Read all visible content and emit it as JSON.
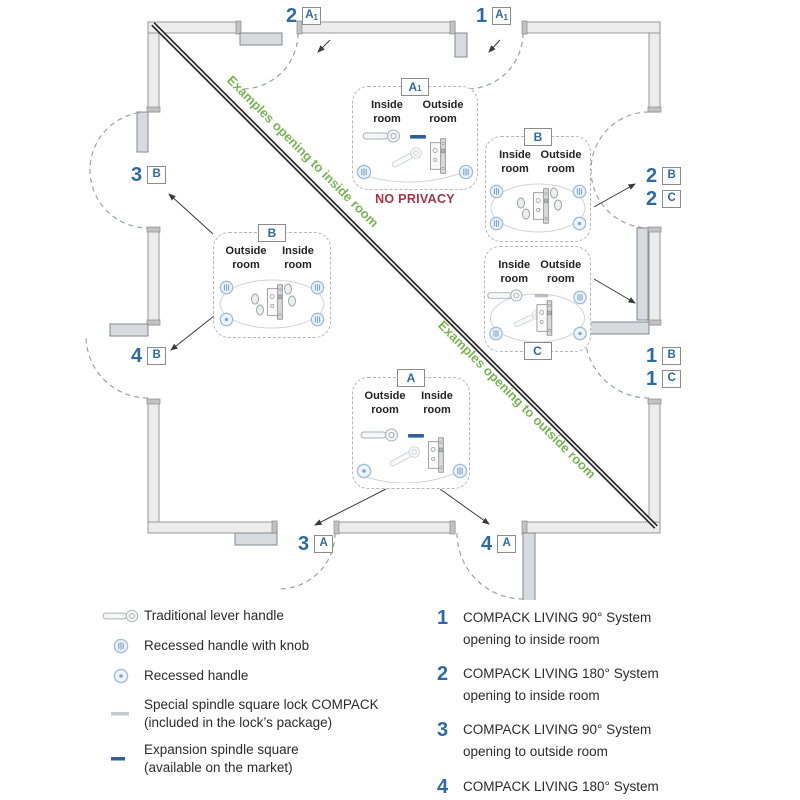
{
  "diagram": {
    "diagonal": {
      "upper_text": "Examples opening to inside room",
      "lower_text": "Examples opening to outside room"
    },
    "door_labels": [
      {
        "position": "top-left",
        "number": "2",
        "letter": "A",
        "sub": "1"
      },
      {
        "position": "top-right",
        "number": "1",
        "letter": "A",
        "sub": "1"
      },
      {
        "position": "left-upper",
        "number": "3",
        "letter": "B",
        "sub": ""
      },
      {
        "position": "left-lower",
        "number": "4",
        "letter": "B",
        "sub": ""
      },
      {
        "position": "right-upper-a",
        "number": "2",
        "letter": "B",
        "sub": ""
      },
      {
        "position": "right-upper-b",
        "number": "2",
        "letter": "C",
        "sub": ""
      },
      {
        "position": "right-lower-a",
        "number": "1",
        "letter": "B",
        "sub": ""
      },
      {
        "position": "right-lower-b",
        "number": "1",
        "letter": "C",
        "sub": ""
      },
      {
        "position": "bottom-left",
        "number": "3",
        "letter": "A",
        "sub": ""
      },
      {
        "position": "bottom-right",
        "number": "4",
        "letter": "A",
        "sub": ""
      }
    ],
    "boxes": [
      {
        "id": "a1",
        "tab": "A",
        "tab_sub": "1",
        "left_room": "Inside room",
        "right_room": "Outside room",
        "note": "NO PRIVACY"
      },
      {
        "id": "right-b",
        "tab": "B",
        "tab_sub": "",
        "left_room": "Inside room",
        "right_room": "Outside room"
      },
      {
        "id": "right-c",
        "tab": "C",
        "tab_sub": "",
        "left_room": "Inside room",
        "right_room": "Outside room"
      },
      {
        "id": "left-b",
        "tab": "B",
        "tab_sub": "",
        "left_room": "Outside room",
        "right_room": "Inside room"
      },
      {
        "id": "bottom-a",
        "tab": "A",
        "tab_sub": "",
        "left_room": "Outside room",
        "right_room": "Inside room"
      }
    ]
  },
  "legend": {
    "items": [
      {
        "icon": "lever-handle-icon",
        "label": "Traditional lever handle",
        "sublabel": ""
      },
      {
        "icon": "recessed-handle-knob-icon",
        "label": "Recessed handle with knob",
        "sublabel": ""
      },
      {
        "icon": "recessed-handle-icon",
        "label": "Recessed handle",
        "sublabel": ""
      },
      {
        "icon": "spindle-square-gray-icon",
        "label": "Special spindle square lock COMPACK",
        "sublabel": "(included in the lock’s package)"
      },
      {
        "icon": "spindle-square-blue-icon",
        "label": "Expansion spindle square",
        "sublabel": "(available on the market)"
      }
    ]
  },
  "systems": [
    {
      "number": "1",
      "name": "COMPACK LIVING 90° System",
      "detail": "opening to inside room"
    },
    {
      "number": "2",
      "name": "COMPACK LIVING 180° System",
      "detail": "opening to inside room"
    },
    {
      "number": "3",
      "name": "COMPACK LIVING 90° System",
      "detail": "opening to outside room"
    },
    {
      "number": "4",
      "name": "COMPACK LIVING 180° System",
      "detail": "opening to outside room"
    }
  ],
  "colors": {
    "accent_blue": "#2d6aa3",
    "green": "#79b552",
    "red": "#a93342"
  }
}
